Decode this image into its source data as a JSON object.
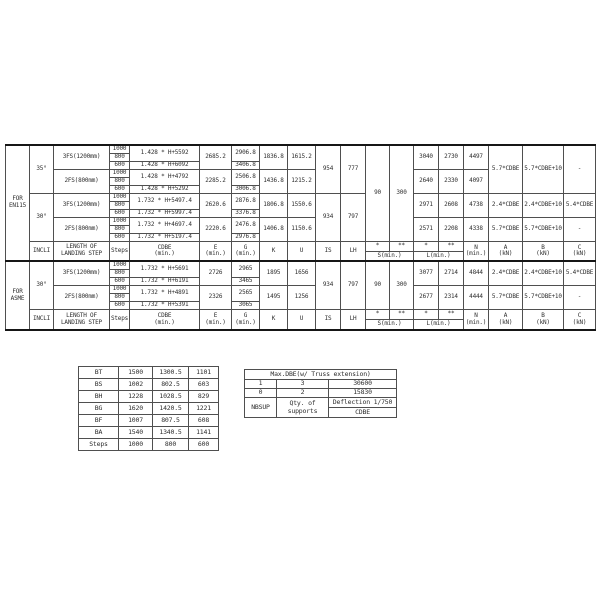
{
  "main_table": {
    "steps": [
      "1000",
      "800",
      "600"
    ],
    "header": {
      "incl": "INCLI",
      "landing_step": "LENGTH OF LANDING STEP",
      "steps": "Steps",
      "cdbe_l1": "CDBE",
      "cdbe_l2": "(min.)",
      "e_l1": "E",
      "e_l2": "(min.)",
      "g_l1": "G",
      "g_l2": "(min.)",
      "k": "K",
      "u": "U",
      "is": "IS",
      "lh": "LH",
      "star": "*",
      "dblstar": "**",
      "s_min": "S(min.)",
      "l_min": "L(min.)",
      "n_l1": "N",
      "n_l2": "(min.)",
      "a_l1": "A",
      "a_l2": "(kN)",
      "b_l1": "B",
      "b_l2": "(kN)",
      "c_l1": "C",
      "c_l2": "(kN)"
    },
    "en115": {
      "group": "FOR EN115",
      "s1": "90",
      "s2": "300",
      "deg35": {
        "angle": "35°",
        "is": "954",
        "lh": "777",
        "a": "5.7*CDBE",
        "b": "5.7*CDBE+10",
        "c": "-",
        "fs3": {
          "label": "3FS(1200mm)",
          "f_hi": "1.428 * H+5592",
          "f_lo": "1.428 * H+6092",
          "e": "2685.2",
          "g_hi": "2906.8",
          "g_lo": "3406.8",
          "k": "1836.8",
          "u": "1615.2",
          "l1": "3040",
          "l2": "2730",
          "n": "4497"
        },
        "fs2": {
          "label": "2FS(800mm)",
          "f_hi": "1.428 * H+4792",
          "f_lo": "1.428 * H+5292",
          "e": "2285.2",
          "g_hi": "2506.8",
          "g_lo": "3006.8",
          "k": "1436.8",
          "u": "1215.2",
          "l1": "2640",
          "l2": "2330",
          "n": "4097"
        }
      },
      "deg30": {
        "angle": "30°",
        "is": "934",
        "lh": "797",
        "fs3": {
          "label": "3FS(1200mm)",
          "f_hi": "1.732 * H+5497.4",
          "f_lo": "1.732 * H+5997.4",
          "e": "2620.6",
          "g_hi": "2876.8",
          "g_lo": "3376.8",
          "k": "1806.8",
          "u": "1550.6",
          "l1": "2971",
          "l2": "2608",
          "n": "4738",
          "a": "2.4*CDBE",
          "b": "2.4*CDBE+10",
          "c": "5.4*CDBE"
        },
        "fs2": {
          "label": "2FS(800mm)",
          "f_hi": "1.732 * H+4697.4",
          "f_lo": "1.732 * H+5197.4",
          "e": "2220.6",
          "g_hi": "2476.8",
          "g_lo": "2976.8",
          "k": "1406.8",
          "u": "1150.6",
          "l1": "2571",
          "l2": "2208",
          "n": "4338",
          "a": "5.7*CDBE",
          "b": "5.7*CDBE+10",
          "c": "-"
        }
      }
    },
    "asme": {
      "group": "FOR ASME",
      "s1": "90",
      "s2": "300",
      "deg30": {
        "angle": "30°",
        "is": "934",
        "lh": "797",
        "fs3": {
          "label": "3FS(1200mm)",
          "f_hi": "1.732 * H+5691",
          "f_lo": "1.732 * H+6191",
          "e": "2726",
          "g_hi": "2965",
          "g_lo": "3465",
          "k": "1895",
          "u": "1656",
          "l1": "3077",
          "l2": "2714",
          "n": "4844",
          "a": "2.4*CDBE",
          "b": "2.4*CDBE+10",
          "c": "5.4*CDBE"
        },
        "fs2": {
          "label": "2FS(800mm)",
          "f_hi": "1.732 * H+4891",
          "f_lo": "1.732 * H+5391",
          "e": "2326",
          "g_hi": "2565",
          "g_lo": "3065",
          "k": "1495",
          "u": "1256",
          "l1": "2677",
          "l2": "2314",
          "n": "4444",
          "a": "5.7*CDBE",
          "b": "5.7*CDBE+10",
          "c": "-"
        }
      }
    }
  },
  "left_table": {
    "rows": [
      [
        "BT",
        "1500",
        "1300.5",
        "1101"
      ],
      [
        "BS",
        "1002",
        "802.5",
        "603"
      ],
      [
        "BH",
        "1228",
        "1028.5",
        "829"
      ],
      [
        "BG",
        "1620",
        "1420.5",
        "1221"
      ],
      [
        "BF",
        "1007",
        "807.5",
        "608"
      ],
      [
        "BA",
        "1540",
        "1340.5",
        "1141"
      ],
      [
        "Steps",
        "1000",
        "800",
        "600"
      ]
    ]
  },
  "right_table": {
    "title": "Max.DBE(w/ Truss extension)",
    "rows": [
      [
        "1",
        "3",
        "30600"
      ],
      [
        "0",
        "2",
        "15830"
      ]
    ],
    "footer_col1": "NBSUP",
    "footer_col2": "Qty. of supports",
    "footer_col3_top": "Deflection 1/750",
    "footer_col3_bottom": "CDBE"
  }
}
